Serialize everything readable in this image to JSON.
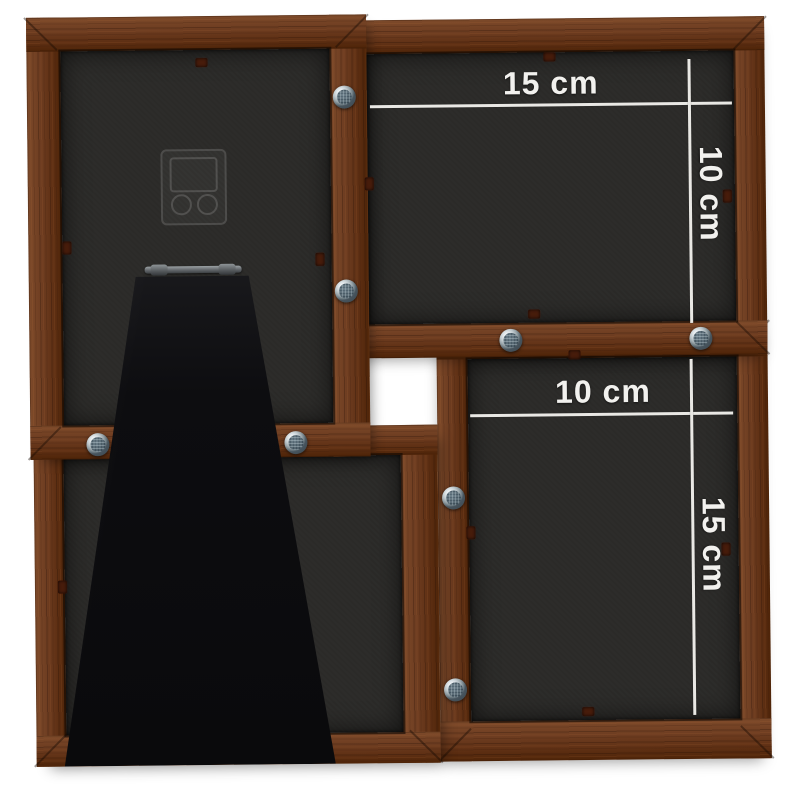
{
  "image": {
    "subject": "Back view of a dark brown wooden collage photo frame for four pictures",
    "view": "rear product photo",
    "background_color": "#ffffff"
  },
  "frames": {
    "top_right": {
      "width_label": "15 cm",
      "height_label": "10 cm"
    },
    "bottom_right": {
      "width_label": "10 cm",
      "height_label": "15 cm"
    }
  },
  "hardware": {
    "screws": {
      "count": 8,
      "name": "rosette screw"
    },
    "staples": {
      "count": 12,
      "name": "staple"
    },
    "hanger_bracket": "clear wall-hanging bracket",
    "stand": "fold-out easel stand",
    "hinge": "easel stand hinge"
  },
  "colors": {
    "wood": "#6e3d21",
    "wood_dark": "#4e2408",
    "backing_panel": "#2b2a28",
    "easel_stand": "#0d0d10",
    "dimension_line": "#e9e8e4",
    "label_text": "#f2f1ee",
    "screw_metal": "#c2cbcf",
    "staple": "#471c0b"
  }
}
